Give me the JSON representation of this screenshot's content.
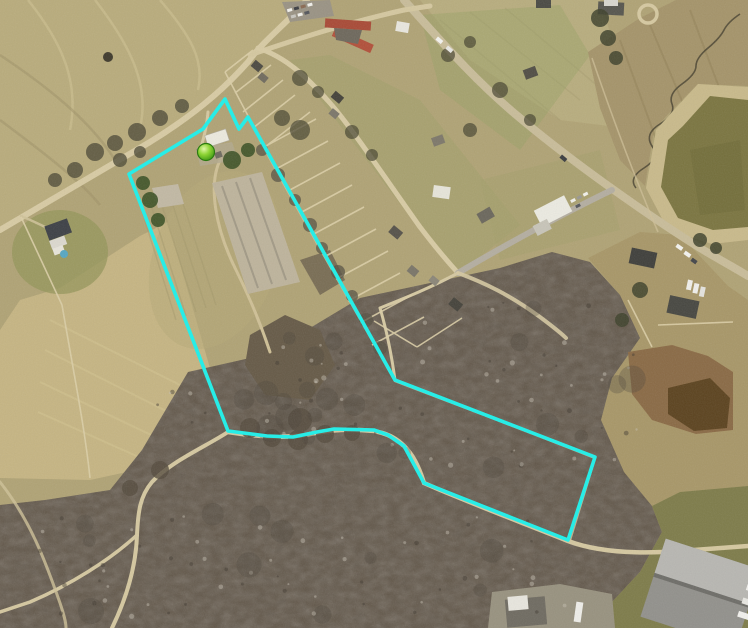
{
  "app": {
    "name": "aerial-parcel-map-view",
    "view_width_px": 748,
    "view_height_px": 628
  },
  "map": {
    "imagery_type": "aerial-photograph",
    "overlay": {
      "parcel_boundary": {
        "label": "highlighted-parcel-boundary",
        "color": "#27ede7",
        "stroke_width": 3.6,
        "closed": true,
        "points": [
          [
            225,
            99
          ],
          [
            239,
            129
          ],
          [
            248,
            117
          ],
          [
            395,
            380
          ],
          [
            595,
            457
          ],
          [
            568,
            540
          ],
          [
            424,
            483
          ],
          [
            404,
            446
          ],
          [
            388,
            435
          ],
          [
            374,
            430
          ],
          [
            334,
            429
          ],
          [
            317,
            432
          ],
          [
            293,
            437
          ],
          [
            267,
            436
          ],
          [
            228,
            431
          ],
          [
            129,
            174
          ],
          [
            203,
            129
          ]
        ]
      },
      "location_marker": {
        "label": "selected-location-marker",
        "x": 206,
        "y": 152,
        "radius": 8.5,
        "color_center": "#dff7a6",
        "color_mid": "#8ed435",
        "color_edge": "#3c9613",
        "outline_color": "#2b7a10"
      }
    },
    "scene_palette": {
      "field_base": "#b0a375",
      "plowed_field": "#b9ac7c",
      "bright_field": "#c6b583",
      "grass_olive": "#a09a68",
      "woods": "#615648",
      "pond_water": "#7b7540",
      "pond_bank": "#c9ba8b",
      "road_tan": "#d8cba4",
      "road_gray": "#b4aea1",
      "dirt_light": "#8a6a45",
      "dirt_dark": "#5c431f",
      "grass_green": "#7e7c4a",
      "red_roof": "#b2503a",
      "rubble": "#beb49c"
    },
    "scene_features": [
      "plowed field",
      "farm fields",
      "farmstead barns",
      "residential parcel strip",
      "rural roads",
      "highway",
      "red-roof building",
      "farm pond",
      "creek",
      "wooded hollow",
      "graded dirt area",
      "industrial buildings"
    ]
  }
}
